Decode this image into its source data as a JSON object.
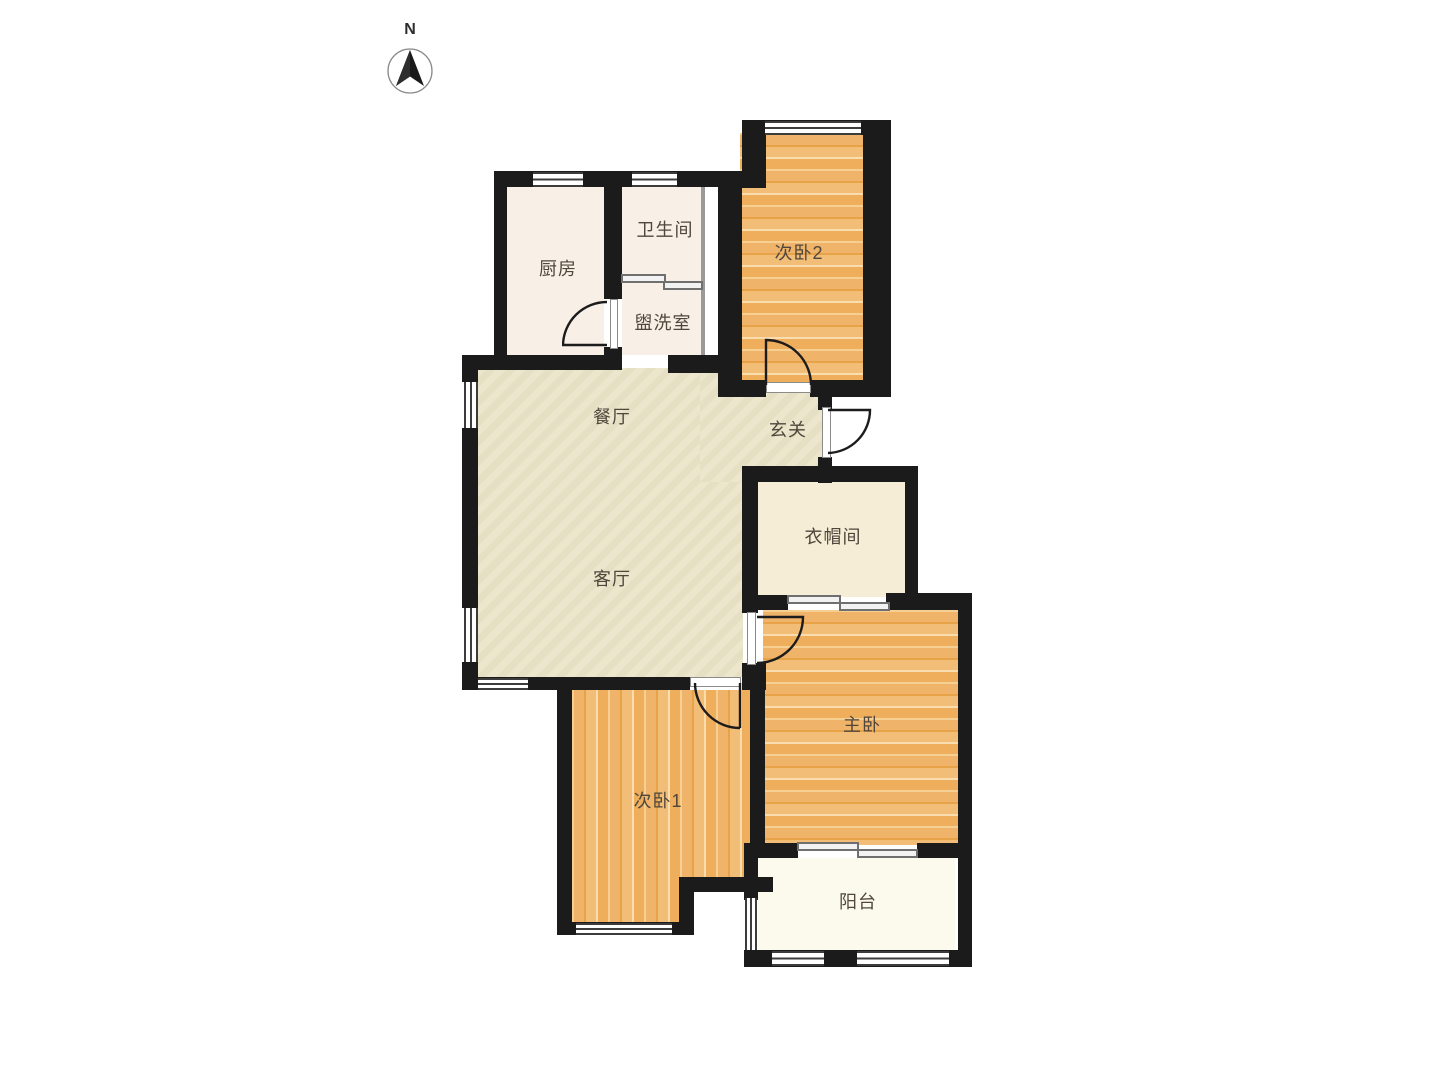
{
  "compass": {
    "label": "N"
  },
  "rooms": {
    "kitchen": {
      "label": "厨房"
    },
    "bathroom": {
      "label": "卫生间"
    },
    "washroom": {
      "label": "盥洗室"
    },
    "bedroom2": {
      "label": "次卧2"
    },
    "dining": {
      "label": "餐厅"
    },
    "foyer": {
      "label": "玄关"
    },
    "living": {
      "label": "客厅"
    },
    "cloakroom": {
      "label": "衣帽间"
    },
    "master": {
      "label": "主卧"
    },
    "bedroom1": {
      "label": "次卧1"
    },
    "balcony": {
      "label": "阳台"
    }
  },
  "colors": {
    "wall": "#1b1b1b",
    "window_line": "#3c3c3c",
    "wood_base": "#efb369",
    "wood_light": "#f6cf93",
    "floor_living": "#e9e3c6",
    "floor_kitchen": "#f8efe6",
    "floor_cloakroom": "#f5edd5",
    "floor_balcony": "#fcfaec",
    "label_text": "#50463c"
  }
}
